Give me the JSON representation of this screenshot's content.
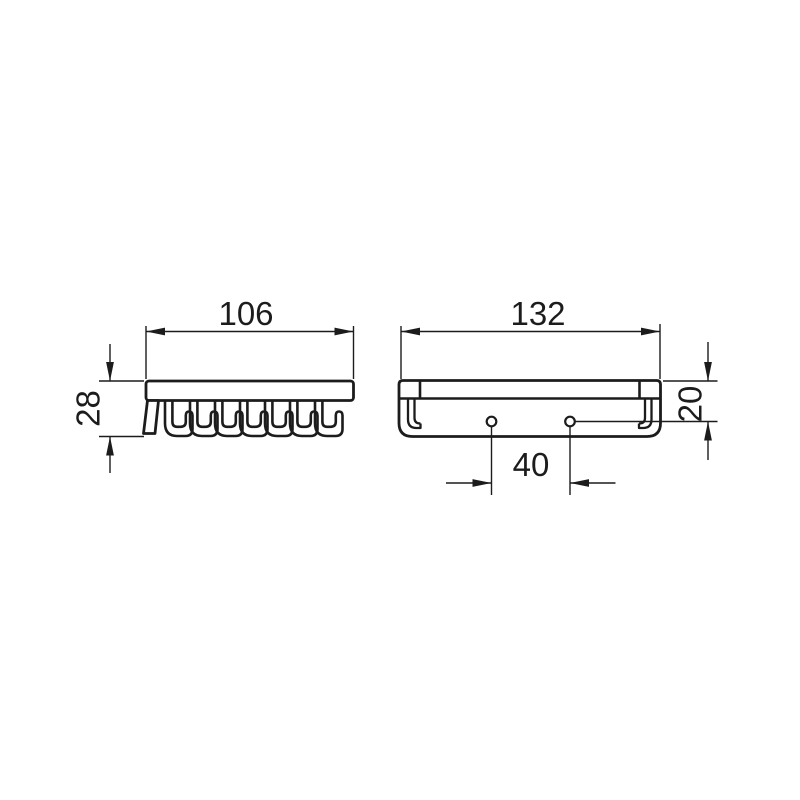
{
  "drawing": {
    "type": "technical-dimension-drawing",
    "background_color": "#ffffff",
    "line_color": "#1c1c1c",
    "views": [
      {
        "name": "side-view",
        "description": "side profile of wire basket: top rail with seven J-shaped wire hooks below",
        "dimensions": [
          {
            "label": "106",
            "axis": "overall width"
          },
          {
            "label": "28",
            "axis": "overall height"
          }
        ]
      },
      {
        "name": "front-view",
        "description": "front profile: rail with end caps, two mounting holes, wire hook ends at both sides",
        "dimensions": [
          {
            "label": "132",
            "axis": "overall width"
          },
          {
            "label": "20",
            "axis": "top edge to hole centerline"
          },
          {
            "label": "40",
            "axis": "hole-to-hole spacing"
          }
        ]
      }
    ],
    "labels": {
      "dim_106": "106",
      "dim_28": "28",
      "dim_132": "132",
      "dim_20": "20",
      "dim_40": "40"
    }
  }
}
